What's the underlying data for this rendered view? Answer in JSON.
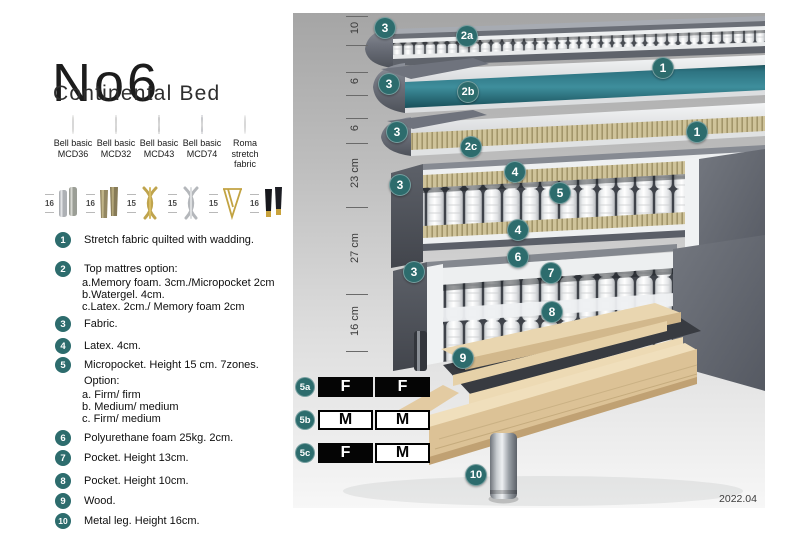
{
  "header": {
    "title": "No6",
    "subtitle": "Continental Bed"
  },
  "fabrics": [
    {
      "line1": "Bell basic",
      "line2": "MCD36",
      "color": "#e3dfd4"
    },
    {
      "line1": "Bell basic",
      "line2": "MCD32",
      "color": "#a7a5a1"
    },
    {
      "line1": "Bell basic",
      "line2": "MCD43",
      "color": "#5d5d5f"
    },
    {
      "line1": "Bell basic",
      "line2": "MCD74",
      "color": "#3d4467"
    },
    {
      "line1": "Roma",
      "line2": "stretch fabric",
      "color": "#fbfbfb"
    }
  ],
  "legs": [
    {
      "height": "16",
      "type": "cylinder-metal-pair"
    },
    {
      "height": "16",
      "type": "block-wood-pair"
    },
    {
      "height": "15",
      "type": "twisted-gold"
    },
    {
      "height": "15",
      "type": "twisted-silver"
    },
    {
      "height": "15",
      "type": "hairpin-gold"
    },
    {
      "height": "16",
      "type": "black-gold-tip-pair"
    }
  ],
  "layer_list": [
    {
      "num": "1",
      "text": "Stretch fabric quilted with wadding."
    },
    {
      "num": "2",
      "text": "Top mattres option:",
      "sub": [
        "a.Memory foam. 3cm./Micropocket 2cm",
        "b.Watergel. 4cm.",
        "c.Latex. 2cm./ Memory foam 2cm"
      ]
    },
    {
      "num": "3",
      "text": "Fabric."
    },
    {
      "num": "4",
      "text": "Latex. 4cm."
    },
    {
      "num": "5",
      "text": "Micropocket. Height 15 cm. 7zones. Option:",
      "sub": [
        "a. Firm/ firm",
        "b. Medium/ medium",
        "c. Firm/ medium"
      ]
    },
    {
      "num": "6",
      "text": "Polyurethane foam 25kg. 2cm."
    },
    {
      "num": "7",
      "text": "Pocket. Height 13cm."
    },
    {
      "num": "8",
      "text": "Pocket. Height 10cm."
    },
    {
      "num": "9",
      "text": "Wood."
    },
    {
      "num": "10",
      "text": "Metal leg. Height 16cm."
    }
  ],
  "diagram": {
    "dimensions": [
      "10",
      "6",
      "6",
      "23 cm",
      "27 cm",
      "16 cm"
    ],
    "badges": [
      "3",
      "2a",
      "1",
      "3",
      "2b",
      "3",
      "2c",
      "1",
      "4",
      "5",
      "3",
      "4",
      "6",
      "7",
      "3",
      "8",
      "9",
      "10"
    ],
    "firmness": [
      {
        "label": "5a",
        "cells": [
          {
            "text": "F",
            "cls": "cell dark"
          },
          {
            "text": "F",
            "cls": "cell dark"
          }
        ]
      },
      {
        "label": "5b",
        "cells": [
          {
            "text": "M",
            "cls": "cell light"
          },
          {
            "text": "M",
            "cls": "cell light"
          }
        ]
      },
      {
        "label": "5c",
        "cells": [
          {
            "text": "F",
            "cls": "cell dark"
          },
          {
            "text": "M",
            "cls": "cell light"
          }
        ]
      }
    ],
    "version": "2022.04"
  },
  "colors": {
    "badge": "#2d6c6d",
    "watergel": "#35818f",
    "wood": "#dcc296"
  }
}
